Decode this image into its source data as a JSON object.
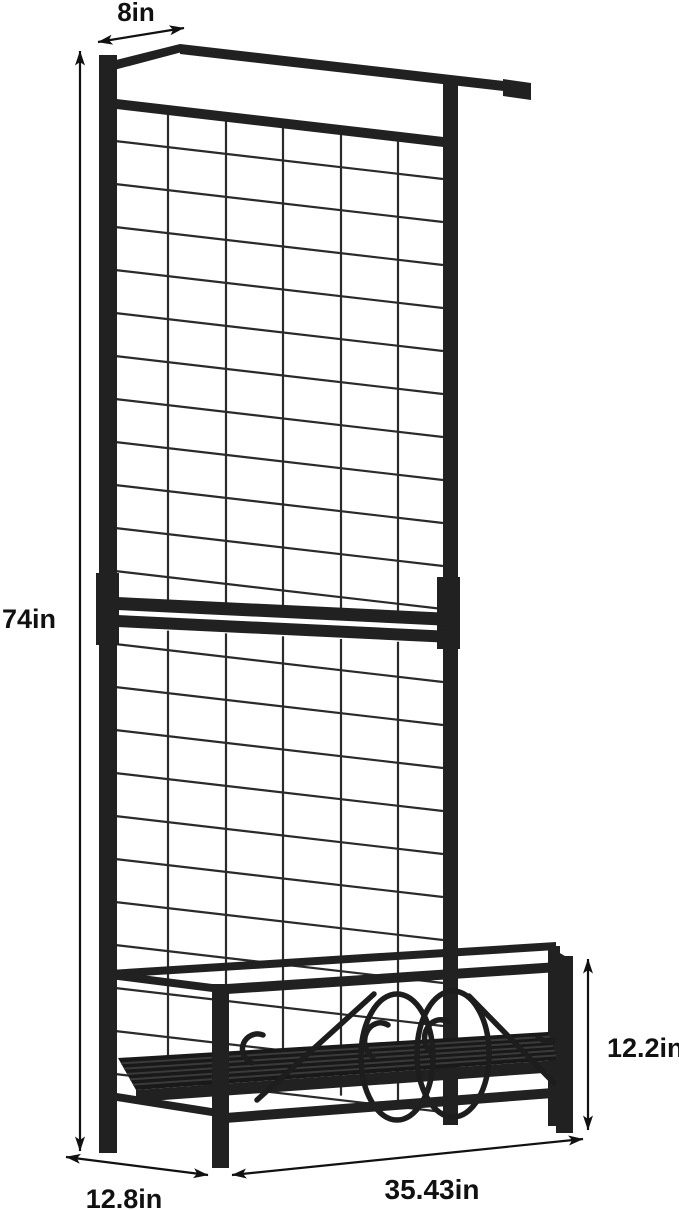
{
  "diagram": {
    "name": "trellis-planter-dimension-diagram",
    "background_color": "#ffffff",
    "frame_color": "#212121",
    "mesh_color": "#2a2a2a",
    "scroll_color": "#1d1d1d",
    "slat_color": "#3a3a3a",
    "shelf_color": "#191919",
    "annotation_color": "#111111",
    "dimensions": {
      "top_bar_depth": "8in",
      "overall_height": "74in",
      "planter_height": "12.2in",
      "overall_width": "35.43in",
      "base_depth": "12.8in"
    }
  }
}
